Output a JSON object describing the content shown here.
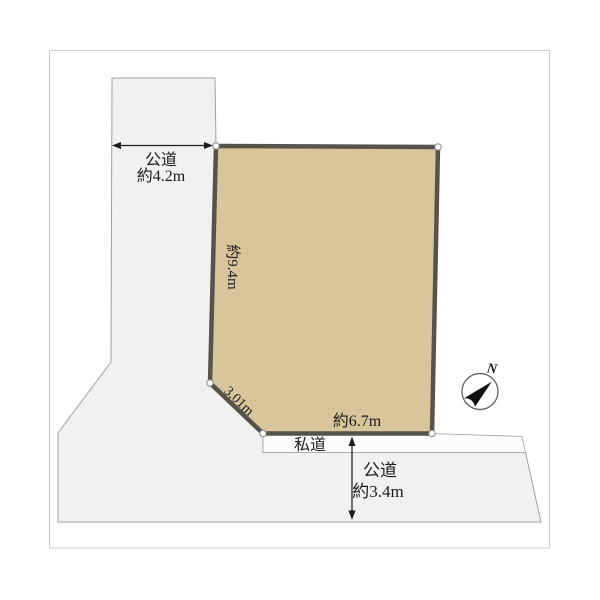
{
  "page": {
    "background": "#ffffff"
  },
  "diagram": {
    "kind": "land-plot-layout",
    "labels": {
      "road_left_name": "公道",
      "road_left_width": "約4.2m",
      "edge_left_length": "約9.4m",
      "edge_diagonal_length": "3.01m",
      "edge_bottom_length": "約6.7m",
      "private_road": "私道",
      "road_bottom_name": "公道",
      "road_bottom_width": "約3.4m",
      "compass_north": "N"
    },
    "colors": {
      "plot_fill": "#d8c59b",
      "plot_border": "#57534b",
      "road_fill": "#f1f1f2",
      "private_road_fill": "#fcfcfd",
      "line": "#a0a0a0",
      "frame": "#cccccc",
      "text": "#1c1c1c"
    }
  }
}
